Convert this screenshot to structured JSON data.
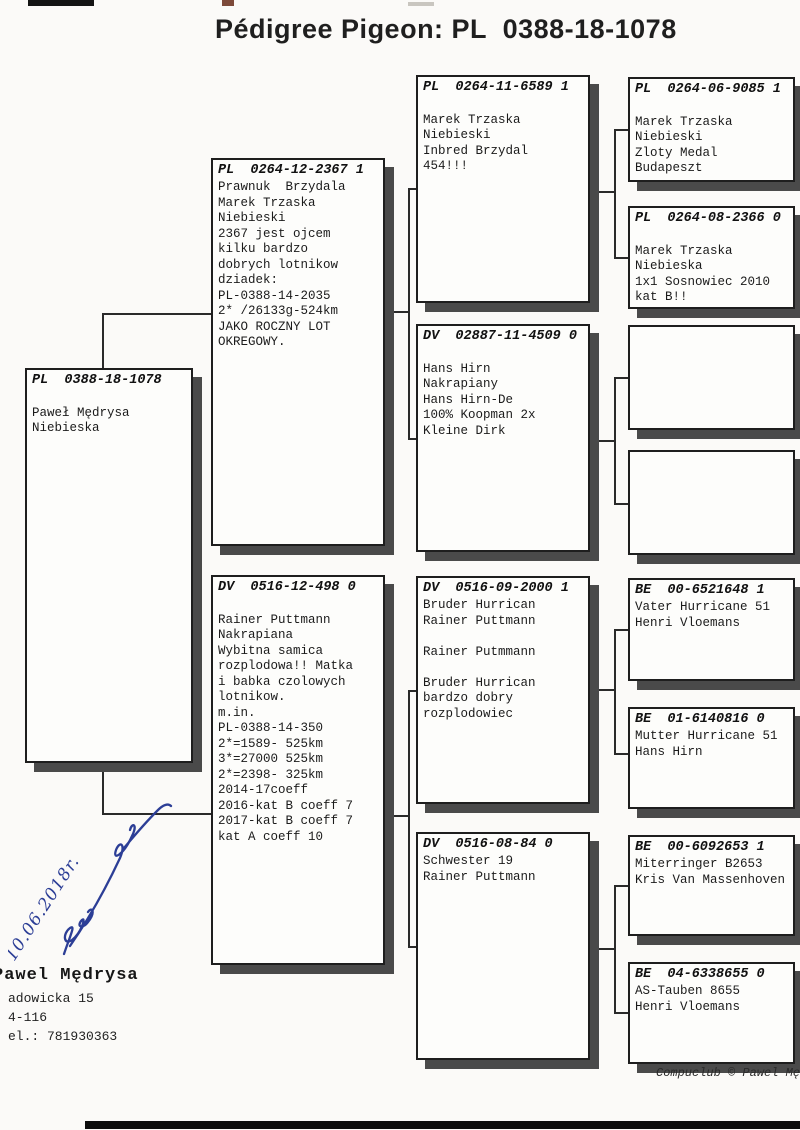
{
  "title": "Pédigree Pigeon: PL  0388-18-1078",
  "boxes": {
    "subject": {
      "ring": "PL  0388-18-1078",
      "body": "\nPaweł Mędrysa\nNiebieska"
    },
    "sire": {
      "ring": "PL  0264-12-2367 1",
      "body": "Prawnuk  Brzydala\nMarek Trzaska\nNiebieski\n2367 jest ojcem\nkilku bardzo\ndobrych lotnikow\ndziadek:\nPL-0388-14-2035\n2* /26133g-524km\nJAKO ROCZNY LOT\nOKREGOWY."
    },
    "dam": {
      "ring": "DV  0516-12-498 0",
      "body": "\nRainer Puttmann\nNakrapiana\nWybitna samica\nrozplodowa!! Matka\ni babka czolowych\nlotnikow.\nm.in.\nPL-0388-14-350\n2*=1589- 525km\n3*=27000 525km\n2*=2398- 325km\n2014-17coeff\n2016-kat B coeff 7\n2017-kat B coeff 7\nkat A coeff 10"
    },
    "pp": {
      "ring": "PL  0264-11-6589 1",
      "body": "\nMarek Trzaska\nNiebieski\nInbred Brzydal\n454!!!"
    },
    "pm": {
      "ring": "DV  02887-11-4509 0",
      "body": "\nHans Hirn\nNakrapiany\nHans Hirn-De\n100% Koopman 2x\nKleine Dirk"
    },
    "mp": {
      "ring": "DV  0516-09-2000 1",
      "body": "Bruder Hurrican\nRainer Puttmann\n\nRainer Putmmann\n\nBruder Hurrican\nbardzo dobry\nrozplodowiec"
    },
    "mm": {
      "ring": "DV  0516-08-84 0",
      "body": "Schwester 19\nRainer Puttmann"
    },
    "ppp": {
      "ring": "PL  0264-06-9085 1",
      "body": "\nMarek Trzaska\nNiebieski\nZloty Medal\nBudapeszt"
    },
    "ppm": {
      "ring": "PL  0264-08-2366 0",
      "body": "\nMarek Trzaska\nNiebieska\n1x1 Sosnowiec 2010\nkat B!!"
    },
    "pmp": {
      "ring": "",
      "body": ""
    },
    "pmm": {
      "ring": "",
      "body": ""
    },
    "mpp": {
      "ring": "BE  00-6521648 1",
      "body": "Vater Hurricane 51\nHenri Vloemans"
    },
    "mpm": {
      "ring": "BE  01-6140816 0",
      "body": "Mutter Hurricane 51\nHans Hirn"
    },
    "mmp": {
      "ring": "BE  00-6092653 1",
      "body": "Miterringer B2653\nKris Van Massenhoven"
    },
    "mmm": {
      "ring": "BE  04-6338655 0",
      "body": "AS-Tauben 8655\nHenri Vloemans"
    }
  },
  "footer": {
    "owner_name": "Pawel Mędrysa",
    "address_line1": "adowicka 15",
    "address_line2": "4-116",
    "phone_line": "el.: 781930363",
    "software_credit": "Compuclub © Pawel Mędrysa"
  },
  "handwriting": {
    "date": "10.06.2018r.",
    "ink_color": "#2c3e96"
  },
  "colors": {
    "paper": "#fbfaf8",
    "box_border": "#1e1e1e",
    "box_shadow": "#4a4a4a",
    "connector": "#2a2a2a"
  }
}
